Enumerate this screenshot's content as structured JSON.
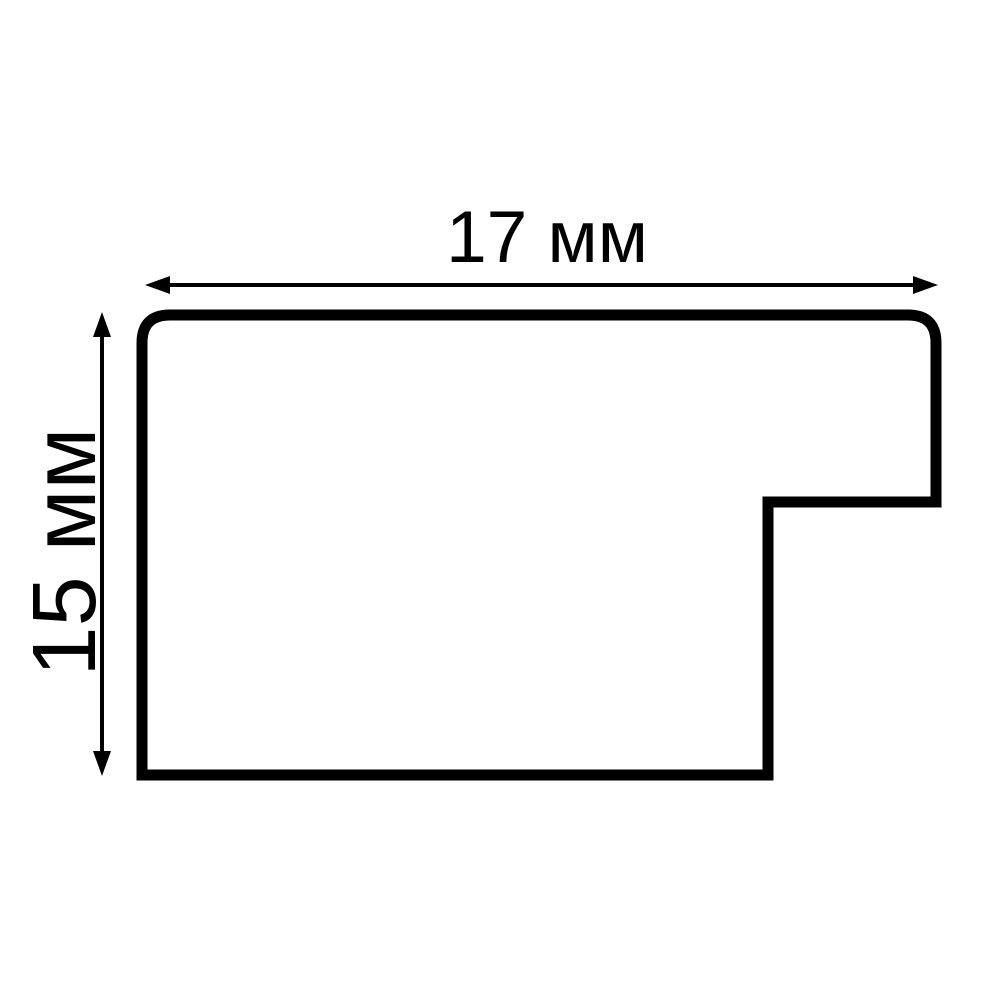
{
  "diagram": {
    "kind": "moulding-profile-cross-section",
    "width_dimension": {
      "label": "17 мм"
    },
    "height_dimension": {
      "label": "15 мм"
    },
    "colors": {
      "line": "#000000",
      "background": "#ffffff"
    }
  }
}
